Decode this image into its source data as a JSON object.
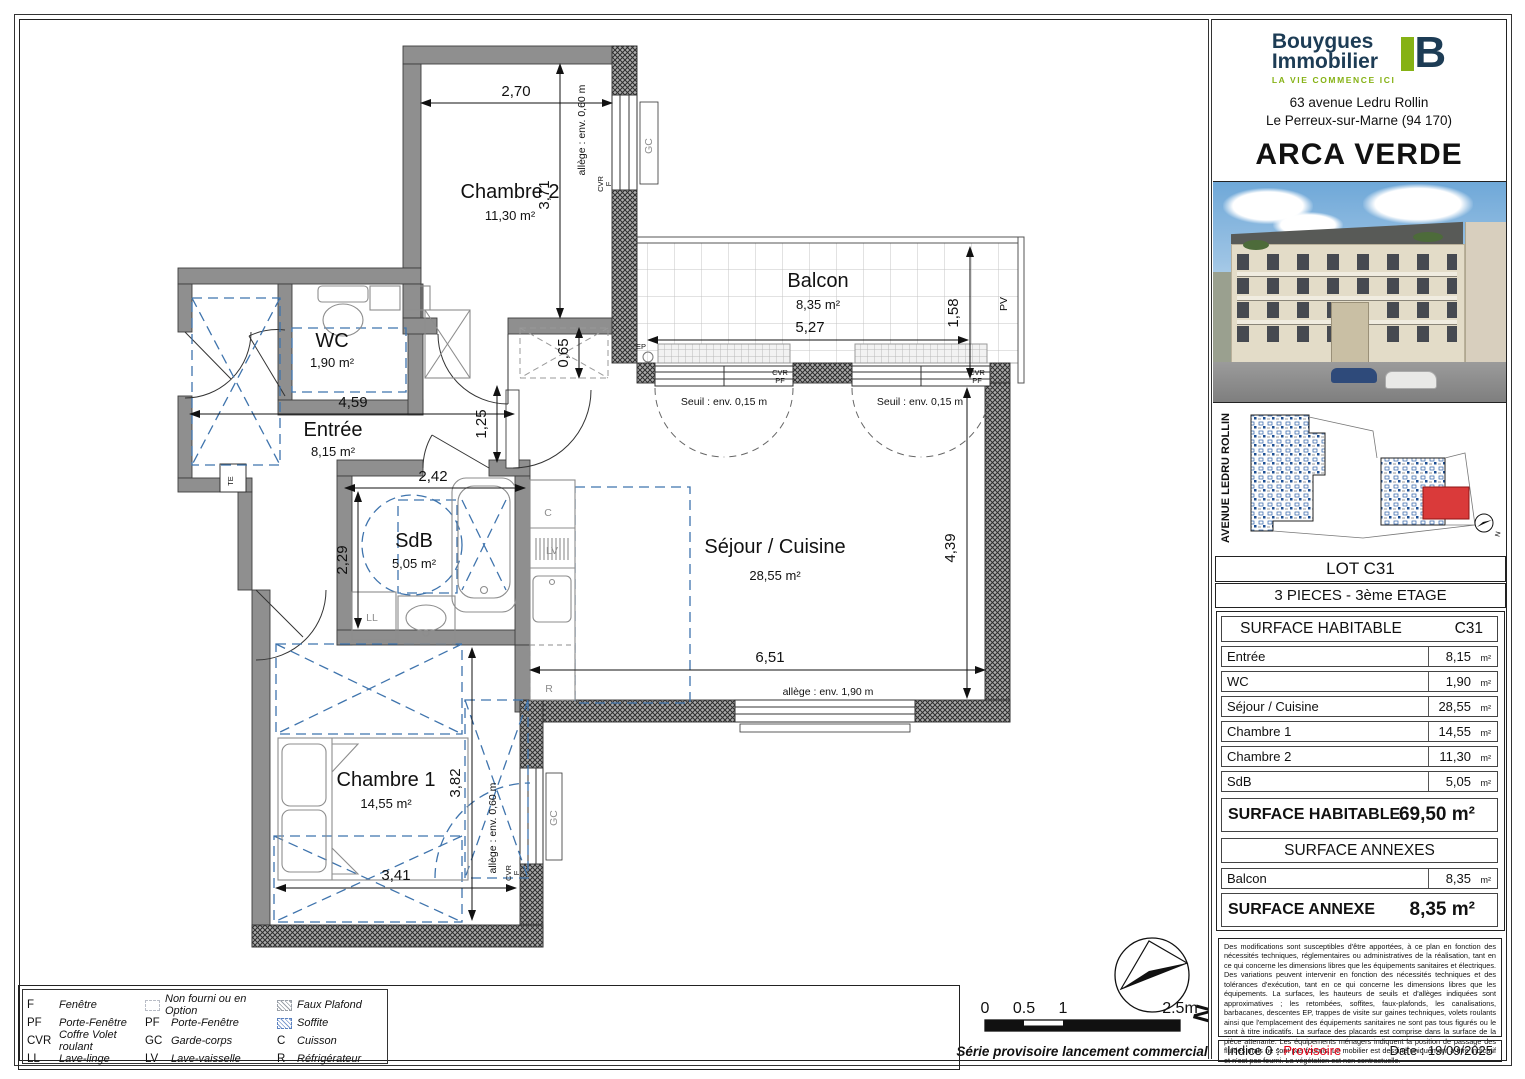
{
  "panel": {
    "logo": {
      "line1": "Bouygues",
      "line2": "Immobilier",
      "tagline": "LA VIE COMMENCE ICI",
      "mark": "B",
      "navy": "#1d3c55",
      "green": "#86b215"
    },
    "address_line1": "63 avenue Ledru Rollin",
    "address_line2": "Le Perreux-sur-Marne (94 170)",
    "project": "ARCA VERDE",
    "avenue_label": "AVENUE LEDRU ROLLIN",
    "lot": "LOT C31",
    "type_floor": "3 PIECES - 3ème ETAGE",
    "table": {
      "header_left": "SURFACE HABITABLE",
      "header_right": "C31",
      "rows": [
        {
          "label": "Entrée",
          "value": "8,15",
          "unit": "m²"
        },
        {
          "label": "WC",
          "value": "1,90",
          "unit": "m²"
        },
        {
          "label": "Séjour / Cuisine",
          "value": "28,55",
          "unit": "m²"
        },
        {
          "label": "Chambre 1",
          "value": "14,55",
          "unit": "m²"
        },
        {
          "label": "Chambre 2",
          "value": "11,30",
          "unit": "m²"
        },
        {
          "label": "SdB",
          "value": "5,05",
          "unit": "m²"
        }
      ],
      "total_label": "SURFACE HABITABLE",
      "total_value": "69,50 m²",
      "annex_header": "SURFACE ANNEXES",
      "annex_row": {
        "label": "Balcon",
        "value": "8,35",
        "unit": "m²"
      },
      "annex_total_label": "SURFACE ANNEXE",
      "annex_total_value": "8,35 m²"
    },
    "disclaimer": "Des modifications sont susceptibles d'être apportées, à ce plan en fonction des nécessités techniques, réglementaires ou administratives de la réalisation, tant en ce qui concerne les dimensions libres que les équipements sanitaires et électriques. Des variations peuvent intervenir en fonction des nécessités techniques et des tolérances d'exécution, tant en ce qui concerne les dimensions libres que les équipements. La surfaces, les hauteurs de seuils et d'allèges indiquées sont approximatives ; les retombées, soffites, faux-plafonds, les canalisations, barbacanes, descentes EP, trappes de visite sur gaines techniques, volets roulants ainsi que l'emplacement des équipements sanitaires ne sont pas tous figurés ou le sont à titre indicatifs. La surface des placards est comprise dans la surface de la pièce attenante. Les équipements ménagers indiquent la position de passage des fluides mais ne sont pas fournis. Le mobilier est dessiné uniquement à titre indicatif et n'est pas fourni. La végétation est non contractuelle.",
    "indice_label": "Indice 0 :",
    "indice_value": "Provisoire",
    "date": "Date : 19/09/2025"
  },
  "plan": {
    "rooms": {
      "c2": {
        "name": "Chambre 2",
        "area": "11,30 m²"
      },
      "balcon": {
        "name": "Balcon",
        "area": "8,35 m²"
      },
      "wc": {
        "name": "WC",
        "area": "1,90 m²"
      },
      "entree": {
        "name": "Entrée",
        "area": "8,15 m²"
      },
      "sdb": {
        "name": "SdB",
        "area": "5,05 m²"
      },
      "sejour": {
        "name": "Séjour / Cuisine",
        "area": "28,55 m²"
      },
      "c1": {
        "name": "Chambre 1",
        "area": "14,55 m²"
      }
    },
    "dims": {
      "c2w": "2,70",
      "c2h": "3,71",
      "soffite": "0,65",
      "balconh": "1,58",
      "balconw": "5,27",
      "entree": "4,59",
      "passage": "1,25",
      "sdbw": "2,42",
      "sdbh": "2,29",
      "sejourw": "6,51",
      "sejourh": "4,39",
      "c1h": "3,82",
      "c1w": "3,41"
    },
    "ann": {
      "allege060": "allège : env. 0,60 m",
      "allege190": "allège : env. 1,90 m",
      "seuil": "Seuil : env. 0,15 m",
      "gc": "GC",
      "pv": "PV",
      "ep": "EP",
      "te": "TE",
      "ll": "LL",
      "lv": "LV",
      "c": "C",
      "r": "R",
      "cvr": "CVR",
      "f": "F",
      "pf": "PF"
    }
  },
  "legend": {
    "items": [
      {
        "abbr": "F",
        "label": "Fenêtre"
      },
      {
        "abbr": "PF",
        "label": "Porte-Fenêtre"
      },
      {
        "abbr": "CVR",
        "label": "Coffre Volet roulant"
      },
      {
        "abbr": "LL",
        "label": "Lave-linge"
      },
      {
        "abbr": "",
        "label": "Non fourni ou en Option"
      },
      {
        "abbr": "PF",
        "label": "Porte-Fenêtre"
      },
      {
        "abbr": "GC",
        "label": "Garde-corps"
      },
      {
        "abbr": "LV",
        "label": "Lave-vaisselle"
      },
      {
        "abbr": "",
        "label": "Faux Plafond"
      },
      {
        "abbr": "",
        "label": "Soffite"
      },
      {
        "abbr": "C",
        "label": "Cuisson"
      },
      {
        "abbr": "R",
        "label": "Réfrigérateur"
      }
    ]
  },
  "scalebar": {
    "t0": "0",
    "t05": "0.5",
    "t1": "1",
    "t25": "2.5m"
  },
  "note": "Série provisoire lancement commercial",
  "north": "N"
}
